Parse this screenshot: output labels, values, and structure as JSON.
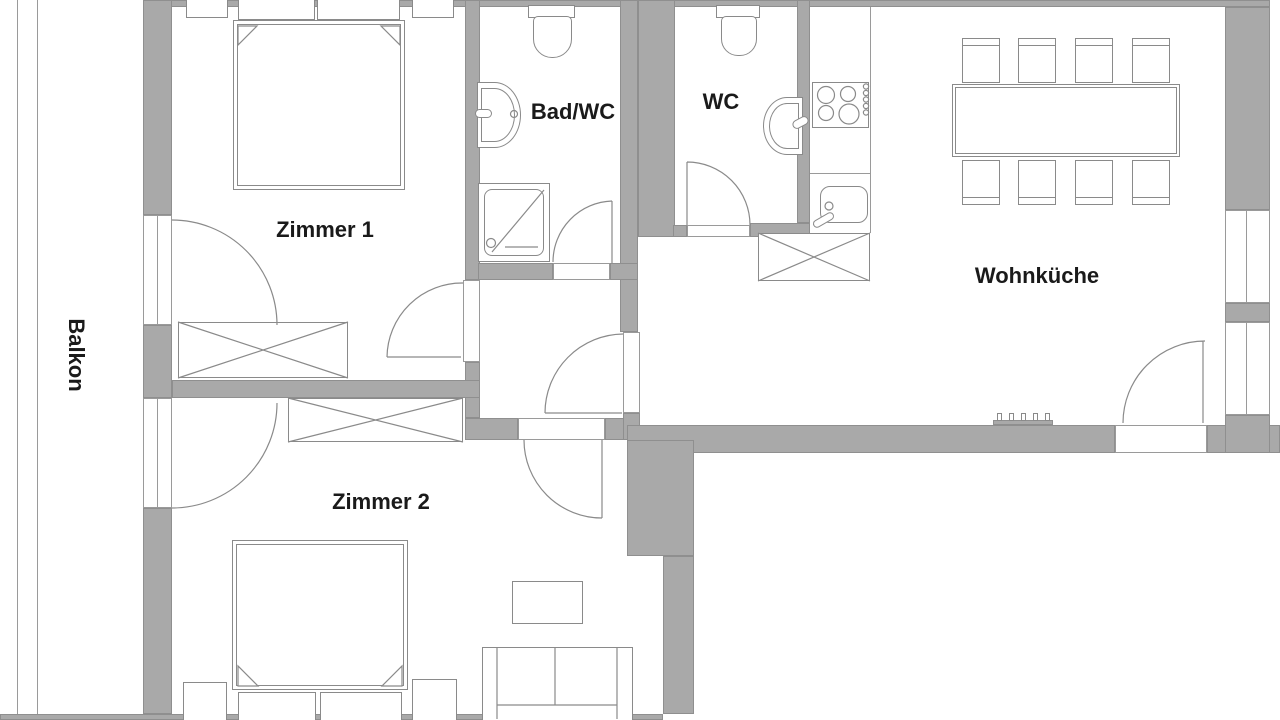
{
  "rooms": {
    "balkon": {
      "label": "Balkon"
    },
    "zimmer1": {
      "label": "Zimmer 1"
    },
    "bad_wc": {
      "label": "Bad/WC"
    },
    "wc": {
      "label": "WC"
    },
    "wohnkueche": {
      "label": "Wohnküche"
    },
    "zimmer2": {
      "label": "Zimmer 2"
    }
  },
  "colors": {
    "wall": "#a9a9a9",
    "wall_edge": "#8f8f8f",
    "line": "#8a8a8a",
    "text": "#1a1a1a",
    "background": "#ffffff"
  },
  "symbols": [
    "double-bed-icon",
    "nightstand-icon",
    "wardrobe-icon",
    "shower-icon",
    "toilet-icon",
    "washbasin-icon",
    "stove-icon",
    "kitchen-sink-icon",
    "dining-table-icon",
    "chair-icon",
    "sofa-icon",
    "side-table-icon",
    "radiator-icon",
    "door-swing-icon",
    "window-icon",
    "balcony-railing-icon"
  ]
}
